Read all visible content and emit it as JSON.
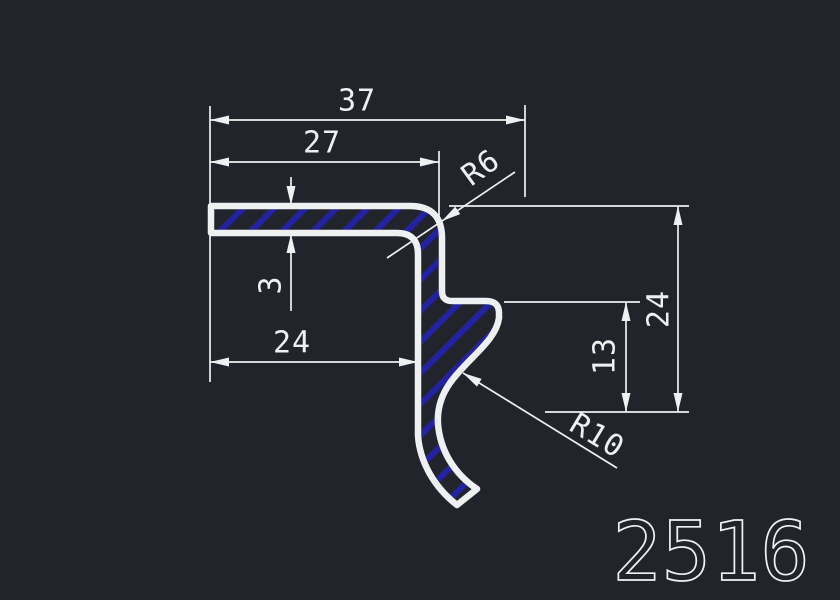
{
  "part_number": "2516",
  "colors": {
    "background": "#21252b",
    "lines": "#eef0f2",
    "hatch": "#2222a2"
  },
  "dimensions": {
    "total_width": "37",
    "top_flange_width": "27",
    "flange_thickness": "3",
    "bottom_width": "24",
    "hook_height": "13",
    "total_height": "24",
    "corner_radius": "R6",
    "groove_radius": "R10"
  }
}
